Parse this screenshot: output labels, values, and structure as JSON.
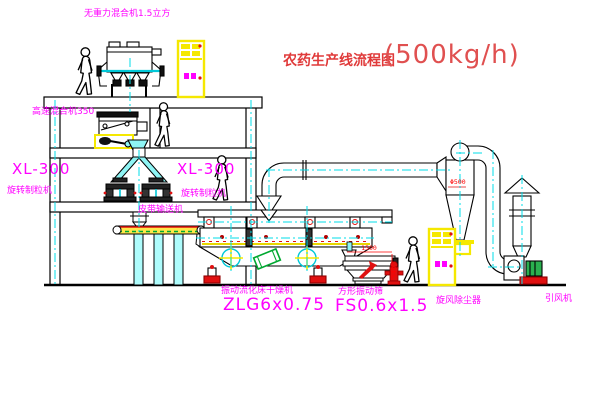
{
  "title": {
    "name_zh": "农药生产线流程图",
    "capacity": "(500kg/h)"
  },
  "equipment_labels": {
    "gravity_mixer": "无重力混合机1.5立方",
    "high_speed_mixer": "高速混合机350",
    "mill_left_model": "XL-300",
    "mill_left_name": "旋转制粒机",
    "mill_right_model": "XL-300",
    "mill_right_name": "旋转制粒机",
    "belt_conveyor": "皮带输送机",
    "dryer_name": "振动流化床干燥机",
    "dryer_model": "ZLG6x0.75",
    "sieve_name": "方形振动筛",
    "sieve_model": "FS0.6x1.5",
    "cyclone": "旋风除尘器",
    "fan": "引风机"
  },
  "dimension_labels": {
    "sieve_width": "1500",
    "sieve_height": "540",
    "cyclone_note": "Φ500"
  },
  "colors": {
    "label_magenta": "#ff00ff",
    "title_red": "#e03a3a",
    "dim_red": "#ff0000",
    "centerline_cyan": "#00dde8",
    "panel_yellow": "#f5e800",
    "belt_yellow": "#ffe84a",
    "machine_green": "#00a830"
  }
}
